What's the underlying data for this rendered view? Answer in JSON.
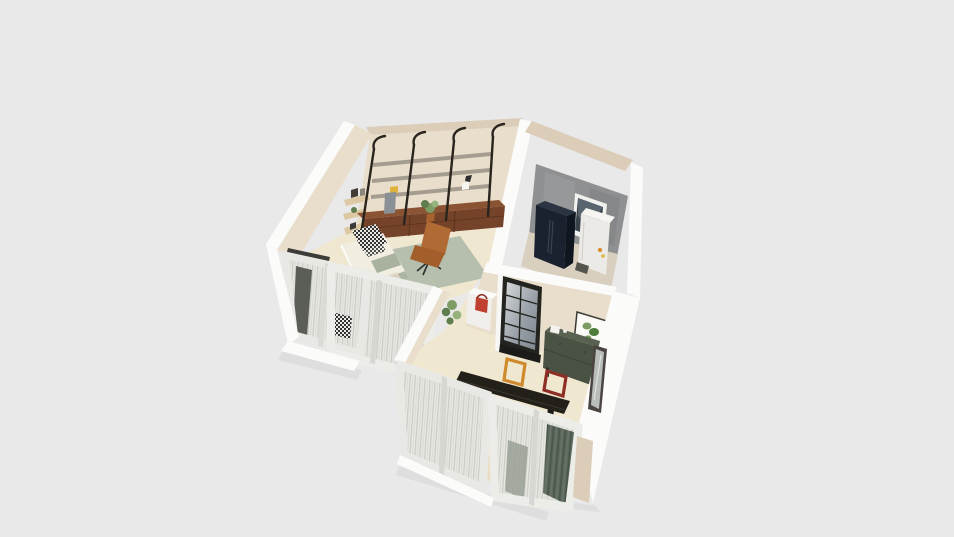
{
  "scene": {
    "description": "3D isometric floor plan render of a small apartment on a plain gray background",
    "rooms": [
      {
        "id": "studio",
        "objects": [
          "wall-shelving-unit",
          "walnut-low-cabinets",
          "lounge-chair",
          "bed",
          "area-rug",
          "triangle-wall-shelves",
          "window-wall-with-sheer-curtains"
        ]
      },
      {
        "id": "kitchen",
        "objects": [
          "concrete-accent-wall",
          "navy-fridge",
          "white-appliance-cabinet",
          "window",
          "floor-bag"
        ]
      },
      {
        "id": "living-dining",
        "objects": [
          "black-glass-door",
          "botanical-print",
          "green-sideboard",
          "white-counter-with-red-kettle",
          "hanging-plant",
          "orange-picture-frame",
          "red-picture-frame",
          "black-console-desk",
          "tall-potted-plant",
          "wood-chair",
          "standing-mirror",
          "window-wall-with-sheer-curtains",
          "dark-green-curtain"
        ]
      }
    ]
  },
  "colors": {
    "bg": "#e9e9e9",
    "wallTop": "#fbfbfa",
    "wallTanFace": "#e9decb",
    "wallTanBand": "#dbcdb8",
    "floorCream": "#f0e7d1",
    "floorKitchen": "#d8cfbe",
    "accentGray": "#8f9091",
    "fridgeNavy": "#1a2230",
    "fridgeNavySide": "#10161f",
    "applianceWhite": "#eceae6",
    "shelfBlack": "#2a241e",
    "shelfBoard": "#a59d8f",
    "cabinetWalnut": "#74432a",
    "cabinetWalnutDark": "#5f3520",
    "chairCognac": "#b06a33",
    "chairCognacSeat": "#a35f2b",
    "rugSage": "#b6bfae",
    "beddingWhite": "#f1ede1",
    "beddingCream": "#e6dfcc",
    "throwSage": "#a9b29f",
    "sideboardGreen": "#4a5244",
    "sideboardGreenTop": "#596251",
    "curtainGreen": "#5c695c",
    "frameOrange": "#d08a2e",
    "frameRed": "#8e2f26",
    "deskBlack": "#232019",
    "plantGreen": "#7d9b63",
    "plantGreenDark": "#5f7d4e",
    "plantGreenLight": "#96b37e",
    "potWhite": "#f2f2ef",
    "glassDark": "#39414b",
    "trimWhite": "#e6e6e2",
    "kettleRed": "#bf4030",
    "mirrorFrame": "#4a4540",
    "mirrorGlass": "#b9bdb9",
    "woodShelfLight": "#dcc9a4",
    "chairWoodTan": "#c89a62",
    "doorFrameBlack": "#23241f"
  }
}
